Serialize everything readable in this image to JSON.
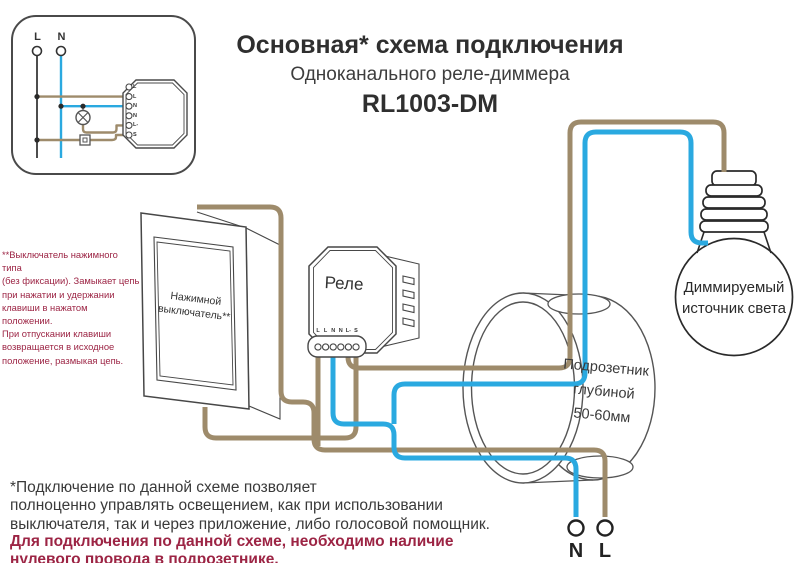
{
  "colors": {
    "wire_brown": "#9e8b6b",
    "wire_blue": "#2aa9e0",
    "accent_red": "#9c2444",
    "text_dark": "#333333",
    "outline": "#474747"
  },
  "title": {
    "line1": "Основная* схема подключения",
    "line2": "Одноканального реле-диммера",
    "model": "RL1003-DM"
  },
  "inset": {
    "phase_label": "L",
    "neutral_label": "N",
    "module_terminals": [
      "L",
      "L",
      "N",
      "N",
      "L-",
      "S"
    ]
  },
  "left_note": "**Выключатель нажимного типа\n(без фиксации). Замыкает цепь\nпри нажатии и удержании\nклавиши в нажатом положении.\nПри отпускании клавиши\nвозвращается в исходное\nположение, размыкая цепь.",
  "switch": {
    "label": "Нажимной\nвыключатель**"
  },
  "relay": {
    "label": "Реле",
    "terminals": [
      "L",
      "L",
      "N",
      "N",
      "L-",
      "S"
    ]
  },
  "mounting_box": {
    "label": "Подрозетник\nглубиной\n50-60мм"
  },
  "lamp": {
    "label": "Диммируемый\nисточник света"
  },
  "mains": {
    "neutral_label": "N",
    "live_label": "L"
  },
  "footer": {
    "note": "*Подключение по данной схеме позволяет\nполноценно управлять освещением, как при использовании\nвыключателя, так и через приложение, либо голосовой помощник.",
    "warning": "Для подключения по данной схеме, необходимо наличие\nнулевого провода в подрозетнике."
  }
}
